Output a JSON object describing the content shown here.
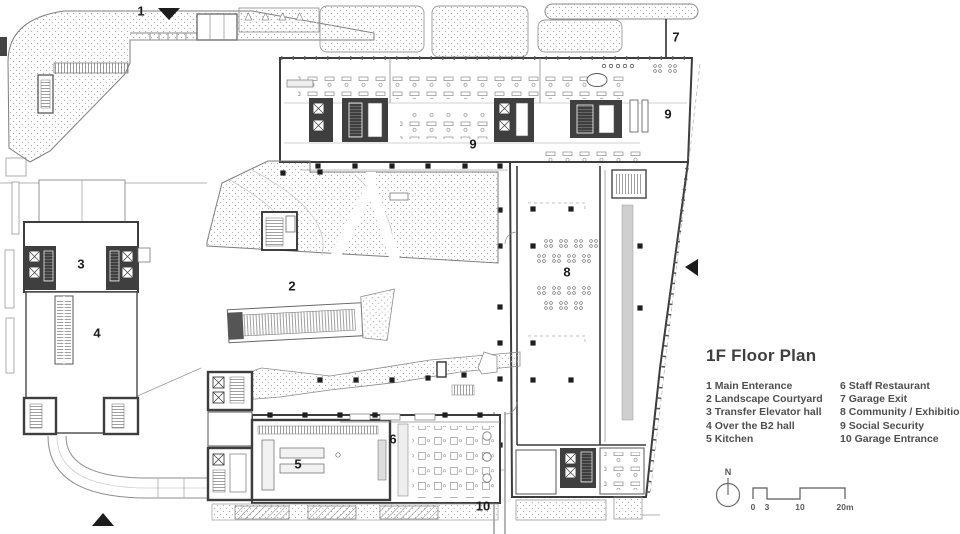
{
  "plan": {
    "labels": [
      "1",
      "7",
      "9",
      "9",
      "3",
      "4",
      "2",
      "8",
      "5",
      "6",
      "10"
    ],
    "icons": [
      "entrance-arrow-north",
      "entrance-arrow-south",
      "entrance-arrow-east"
    ],
    "colors": {
      "ink": "#3d3d3d",
      "stipple": "#adadad",
      "core_fill": "#3f3f3f",
      "paper": "#ffffff"
    }
  },
  "legend": {
    "title": "1F Floor Plan",
    "col1": [
      "1 Main Enterance",
      "2 Landscape Courtyard",
      "3 Transfer Elevator hall",
      "4 Over the B2 hall",
      "5 Kitchen"
    ],
    "col2": [
      "6 Staff Restaurant",
      "7 Garage Exit",
      "8 Community / Exhibition",
      "9 Social Security",
      "10 Garage Entrance"
    ]
  },
  "compass": {
    "label": "N"
  },
  "scalebar": {
    "ticks": [
      "0",
      "3",
      "10",
      "20m"
    ]
  }
}
